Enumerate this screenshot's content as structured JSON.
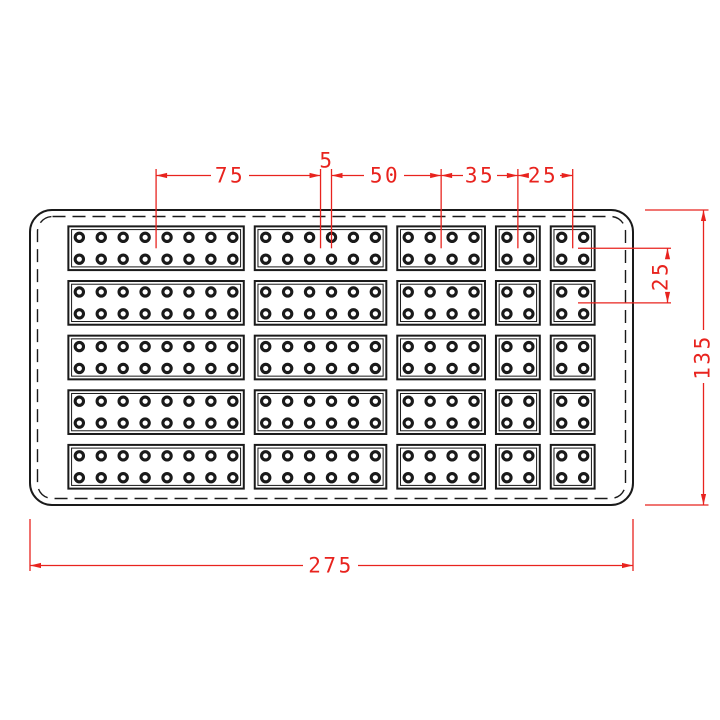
{
  "drawing": {
    "type": "cad-plate-top-view",
    "unit": "mm",
    "plate": {
      "width_mm": 275,
      "height_mm": 135
    },
    "grid": {
      "rows": 5,
      "row_block_height_mm": 20,
      "row_gap_mm": 5,
      "row_margin_mm": 7.5,
      "col_margin_mm": 17.5,
      "col_gap_mm": 5,
      "hole_pitch_mm": 10,
      "hole_inset_mm": 5,
      "columns": [
        {
          "width_mm": 80,
          "holes_per_row": 8
        },
        {
          "width_mm": 60,
          "holes_per_row": 6
        },
        {
          "width_mm": 40,
          "holes_per_row": 4
        },
        {
          "width_mm": 20,
          "holes_per_row": 2
        },
        {
          "width_mm": 20,
          "holes_per_row": 2
        }
      ]
    },
    "dimensions": {
      "top_chain": {
        "d75": "75",
        "d5": "5",
        "d50": "50",
        "d35": "35",
        "d25": "25"
      },
      "right_row_pitch": "25",
      "overall_height": "135",
      "overall_width": "275"
    },
    "colors": {
      "line": "#1a1a1a",
      "dimension_red": "#e8231e",
      "background": "#ffffff"
    }
  }
}
